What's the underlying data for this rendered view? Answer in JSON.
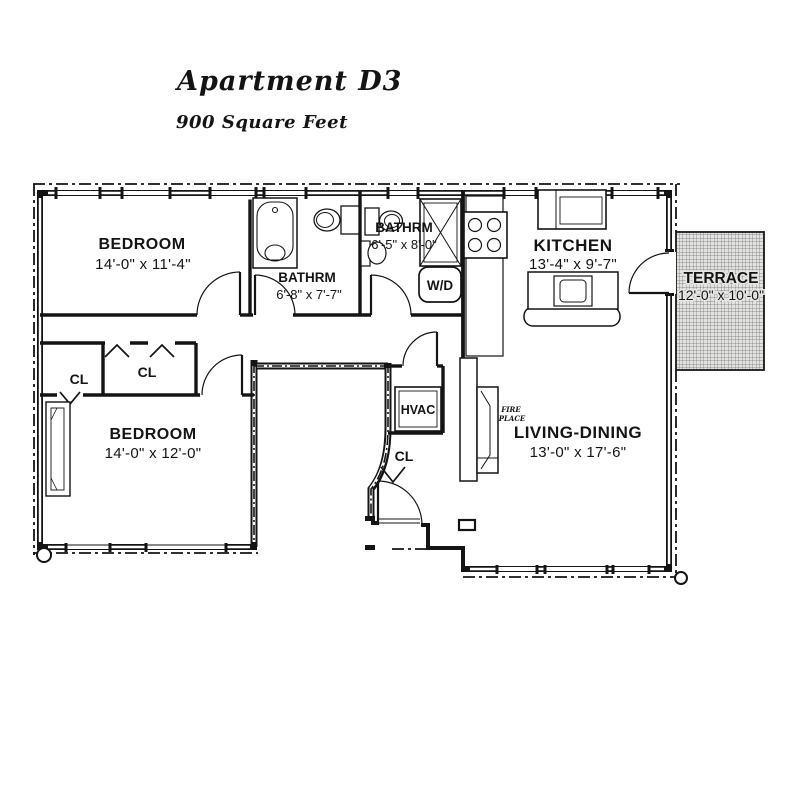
{
  "header": {
    "title": "Apartment D3",
    "subtitle": "900 Square Feet"
  },
  "rooms": [
    {
      "name": "BEDROOM",
      "dims": "14'-0\" x 11'-4\""
    },
    {
      "name": "BATHRM",
      "dims": "6'-8\" x 7'-7\""
    },
    {
      "name": "BATHRM",
      "dims": "6'-5\" x 8'-0\""
    },
    {
      "name": "KITCHEN",
      "dims": "13'-4\" x 9'-7\""
    },
    {
      "name": "TERRACE",
      "dims": "12'-0\" x 10'-0\""
    },
    {
      "name": "BEDROOM",
      "dims": "14'-0\" x 12'-0\""
    },
    {
      "name": "LIVING-DINING",
      "dims": "13'-0\" x 17'-6\""
    }
  ],
  "labels": {
    "closet": "CL",
    "hvac": "HVAC",
    "washer_dryer": "W/D",
    "fireplace": [
      "FIRE",
      "PLACE"
    ]
  },
  "colors": {
    "ink": "#141414",
    "paper": "#ffffff",
    "hatch_bg": "#e3e3e1",
    "hatch_line": "#6f6f6c"
  }
}
